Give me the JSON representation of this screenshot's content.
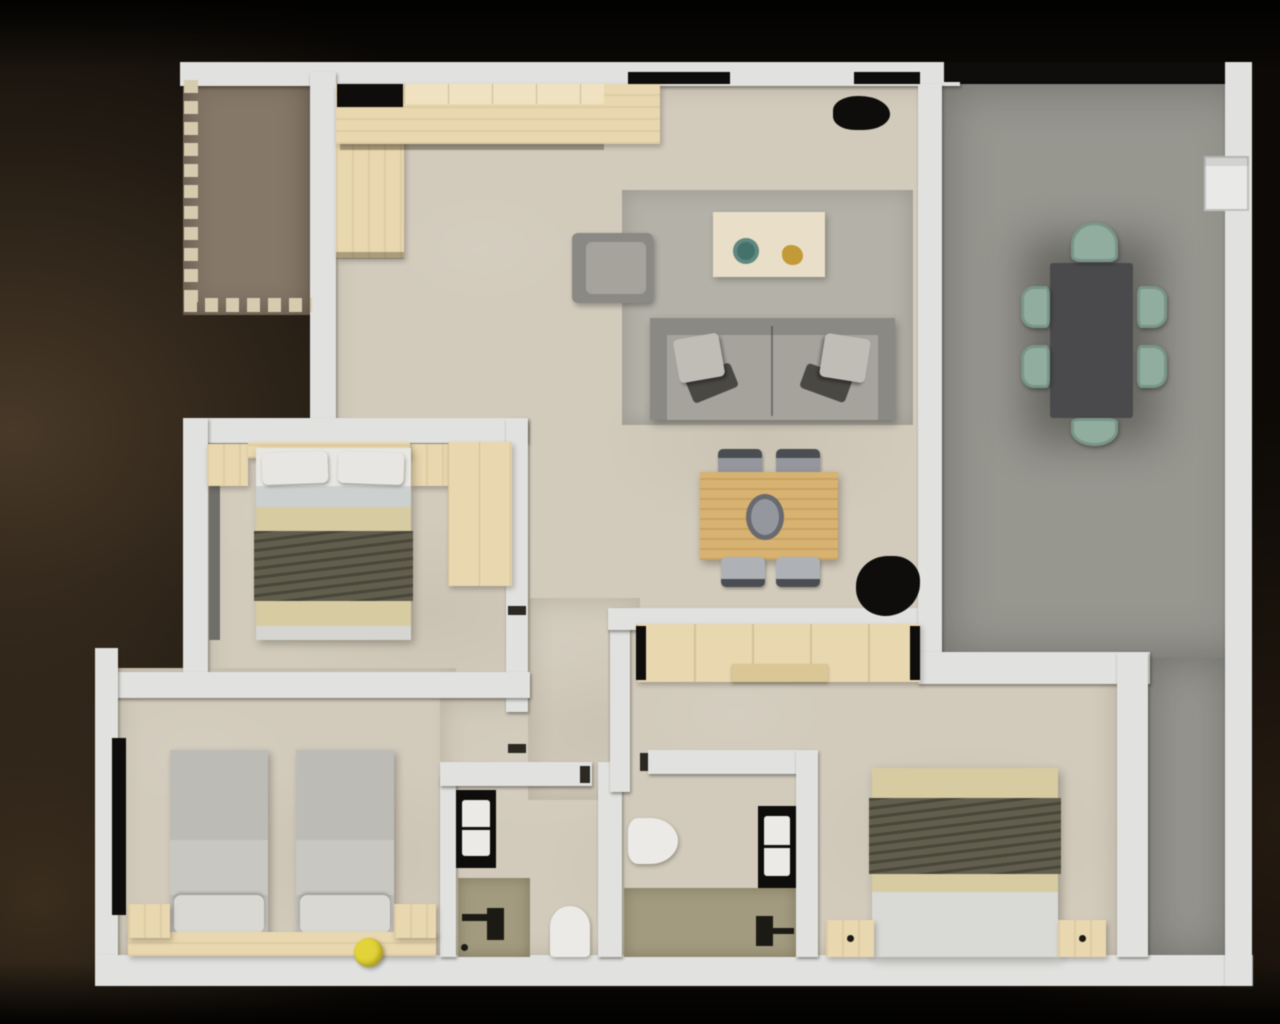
{
  "scene": {
    "description": "Top-down 3D rendered floor plan of an apartment; photorealistic render with no text labels",
    "view": "top-down orthographic",
    "text_labels": []
  },
  "rooms": [
    {
      "id": "entry-porch"
    },
    {
      "id": "kitchen"
    },
    {
      "id": "living-room"
    },
    {
      "id": "hallway"
    },
    {
      "id": "terrace-dining-room"
    },
    {
      "id": "bedroom-double"
    },
    {
      "id": "bedroom-twin"
    },
    {
      "id": "bathroom-left"
    },
    {
      "id": "bathroom-right"
    },
    {
      "id": "bedroom-master"
    }
  ],
  "furniture": {
    "kitchen": [
      "l-shaped-counter",
      "black-cooktop"
    ],
    "living_room": [
      "area-rug",
      "sofa-with-cushions",
      "armchair",
      "coffee-table",
      "decor-plate-teal",
      "decor-gold",
      "black-plant",
      "desk",
      "desk-chairs"
    ],
    "terrace": [
      "dining-table-dark",
      "six-sage-chairs",
      "wall-ac-unit",
      "black-glass-front"
    ],
    "bedroom_double": [
      "double-bed",
      "two-pillows",
      "olive-throw",
      "two-nightstands",
      "wardrobe",
      "window"
    ],
    "bedroom_twin": [
      "single-bed-1",
      "single-bed-2",
      "headboard-shelf",
      "two-side-tables",
      "yellow-pouf",
      "window"
    ],
    "bathroom_left": [
      "black-vanity-with-sink",
      "shower-tray",
      "shower-fixture",
      "toilet"
    ],
    "bathroom_right": [
      "toilet",
      "shower-tray",
      "shower-fixture",
      "black-vanity-with-sink"
    ],
    "bedroom_master": [
      "closet-row",
      "double-bed",
      "olive-throw",
      "two-nightstands"
    ]
  },
  "palette": {
    "bg_dark": "#0c0906",
    "bg_brown": "#483928",
    "wall": "#e1e1df",
    "floor": "#d2cbbc",
    "terrace": "#97968f",
    "porch": "#867868",
    "porch_dash": "#d7cbae",
    "rug": "#b4b2a8",
    "sofa": "#a6a39d",
    "sofa_dark": "#8b8983",
    "cushion": "#c0bdb7",
    "wood": "#e9d7ae",
    "wood_light": "#f0e2bf",
    "desk_wood": "#d9b26e",
    "black": "#0e0d0b",
    "teal": "#43726a",
    "gold": "#c39a35",
    "table_dark": "#4a4a4c",
    "sage": "#8fada0",
    "chair_gray": "#94979d",
    "chair_dark": "#4a4d52",
    "bed_pillow": "#e7e6e2",
    "sheet": "#ccd1d0",
    "blanket": "#d7cba1",
    "throw": "#615e4e",
    "twin_blanket": "#bdbbb6",
    "twin_mid": "#c9c7c2",
    "twin_pillow": "#d9d8d3",
    "yellow": "#e2d334",
    "shower": "#a39b7e",
    "white_fix": "#ebeae6",
    "window": "#6f6e69",
    "ac": "#e9e9e7"
  }
}
